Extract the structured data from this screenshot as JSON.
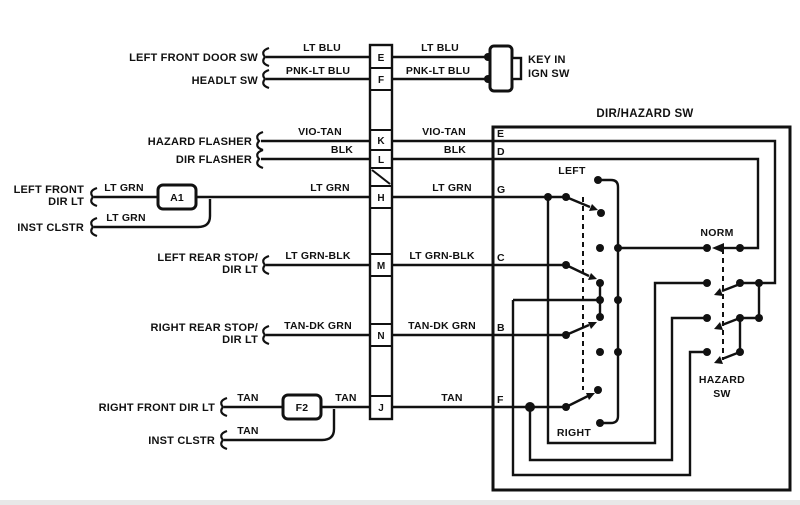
{
  "diagram": {
    "title": "DIR/HAZARD SW",
    "key_switch": {
      "line1": "KEY IN",
      "line2": "IGN SW"
    },
    "junctions": {
      "a1": "A1",
      "f2": "F2"
    },
    "strip_terminals": {
      "e": "E",
      "f": "F",
      "k": "K",
      "l": "L",
      "h": "H",
      "m": "M",
      "n": "N",
      "j": "J"
    },
    "box_terminals": {
      "e": "E",
      "d": "D",
      "g": "G",
      "c": "C",
      "b": "B",
      "f": "F"
    },
    "switch_labels": {
      "left": "LEFT",
      "right": "RIGHT",
      "norm": "NORM",
      "hazard_line1": "HAZARD",
      "hazard_line2": "SW"
    },
    "components": {
      "left_front_door_sw": "LEFT FRONT DOOR SW",
      "headlt_sw": "HEADLT SW",
      "hazard_flasher": "HAZARD FLASHER",
      "dir_flasher": "DIR FLASHER",
      "left_front_dir_lt_1": "LEFT FRONT",
      "left_front_dir_lt_2": "DIR LT",
      "inst_clstr_top": "INST CLSTR",
      "left_rear_1": "LEFT REAR STOP/",
      "left_rear_2": "DIR LT",
      "right_rear_1": "RIGHT REAR STOP/",
      "right_rear_2": "DIR LT",
      "right_front_dir_lt": "RIGHT FRONT DIR LT",
      "inst_clstr_bottom": "INST CLSTR"
    },
    "wire_labels": {
      "lt_blu_left": "LT BLU",
      "lt_blu_right": "LT BLU",
      "pnk_lt_blu_left": "PNK-LT BLU",
      "pnk_lt_blu_right": "PNK-LT BLU",
      "vio_tan_left": "VIO-TAN",
      "vio_tan_right": "VIO-TAN",
      "blk_left": "BLK",
      "blk_right": "BLK",
      "lt_grn_in": "LT GRN",
      "lt_grn_mid": "LT GRN",
      "lt_grn_right": "LT GRN",
      "lt_grn_inst": "LT GRN",
      "lt_grn_blk_left": "LT GRN-BLK",
      "lt_grn_blk_right": "LT GRN-BLK",
      "tan_dk_grn_left": "TAN-DK GRN",
      "tan_dk_grn_right": "TAN-DK GRN",
      "tan_in": "TAN",
      "tan_mid": "TAN",
      "tan_right": "TAN",
      "tan_inst": "TAN"
    },
    "colors": {
      "ink": "#111111",
      "paper": "#ffffff"
    }
  }
}
